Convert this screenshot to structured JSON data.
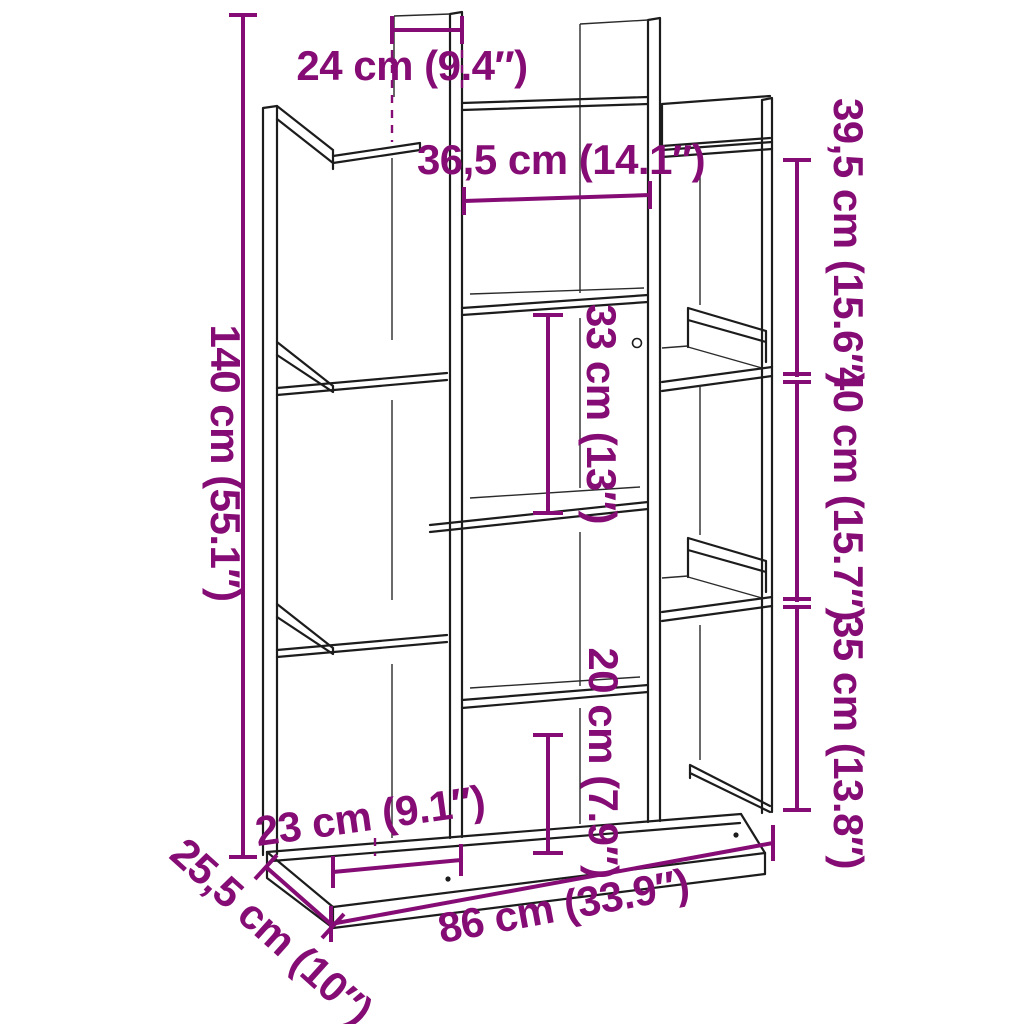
{
  "diagram": {
    "type": "furniture-dimension-diagram",
    "subject": "tree-shaped bookcase line drawing with measurements",
    "accent_color": "#850C74",
    "line_color": "#1c1c1c",
    "background_color": "#ffffff"
  },
  "dimensions": {
    "top_panel_depth": {
      "label": "24 cm (9.4″)"
    },
    "center_opening_width": {
      "label": "36,5 cm (14.1″)"
    },
    "total_height": {
      "label": "140 cm (55.1″)"
    },
    "right_upper_height": {
      "label": "39,5 cm (15.6″)"
    },
    "right_middle_height": {
      "label": "40 cm (15.7″)"
    },
    "right_lower_height": {
      "label": "35 cm (13.8″)"
    },
    "center_opening_height": {
      "label": "33 cm (13″)"
    },
    "bottom_center_height": {
      "label": "20 cm (7.9″)"
    },
    "bottom_left_width": {
      "label": "23 cm (9.1″)"
    },
    "total_width": {
      "label": "86 cm (33.9″)"
    },
    "total_depth": {
      "label": "25,5 cm (10″)"
    }
  }
}
